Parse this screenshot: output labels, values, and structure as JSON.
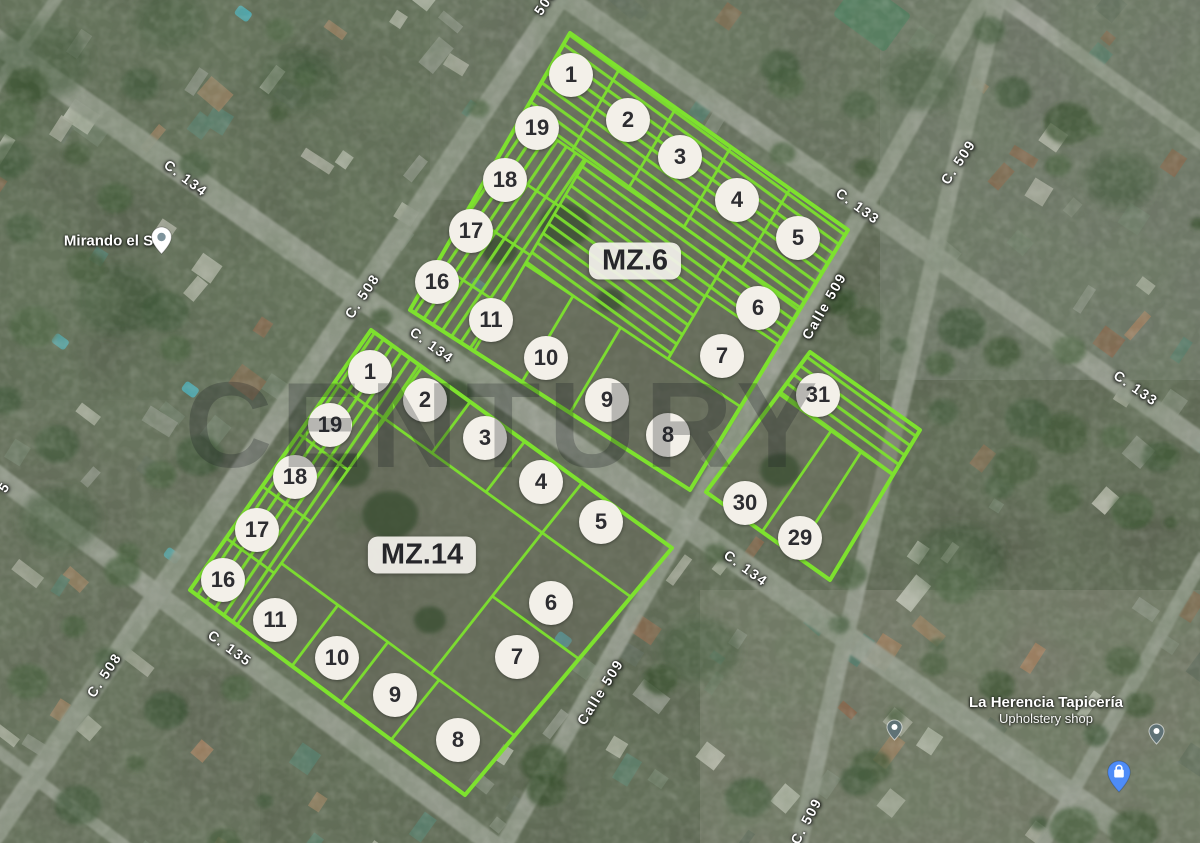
{
  "map_overlay": {
    "watermark_text": "CENTURY",
    "blocks": [
      {
        "name": "mz6",
        "label": "MZ.6",
        "label_x": 635,
        "label_y": 261,
        "lots": [
          {
            "n": "1",
            "x": 571,
            "y": 75
          },
          {
            "n": "2",
            "x": 628,
            "y": 120
          },
          {
            "n": "3",
            "x": 680,
            "y": 157
          },
          {
            "n": "4",
            "x": 737,
            "y": 200
          },
          {
            "n": "5",
            "x": 798,
            "y": 238
          },
          {
            "n": "19",
            "x": 537,
            "y": 128
          },
          {
            "n": "18",
            "x": 505,
            "y": 180
          },
          {
            "n": "17",
            "x": 471,
            "y": 231
          },
          {
            "n": "16",
            "x": 437,
            "y": 282
          },
          {
            "n": "11",
            "x": 491,
            "y": 320
          },
          {
            "n": "10",
            "x": 546,
            "y": 358
          },
          {
            "n": "9",
            "x": 607,
            "y": 400
          },
          {
            "n": "8",
            "x": 668,
            "y": 435
          },
          {
            "n": "6",
            "x": 758,
            "y": 308
          },
          {
            "n": "7",
            "x": 722,
            "y": 356
          }
        ]
      },
      {
        "name": "mz14",
        "label": "MZ.14",
        "label_x": 422,
        "label_y": 555,
        "lots": [
          {
            "n": "1",
            "x": 370,
            "y": 372
          },
          {
            "n": "2",
            "x": 425,
            "y": 400
          },
          {
            "n": "3",
            "x": 485,
            "y": 438
          },
          {
            "n": "4",
            "x": 541,
            "y": 482
          },
          {
            "n": "5",
            "x": 601,
            "y": 522
          },
          {
            "n": "19",
            "x": 330,
            "y": 425
          },
          {
            "n": "18",
            "x": 295,
            "y": 477
          },
          {
            "n": "17",
            "x": 257,
            "y": 530
          },
          {
            "n": "16",
            "x": 223,
            "y": 580
          },
          {
            "n": "11",
            "x": 275,
            "y": 620
          },
          {
            "n": "10",
            "x": 337,
            "y": 658
          },
          {
            "n": "9",
            "x": 395,
            "y": 695
          },
          {
            "n": "8",
            "x": 458,
            "y": 740
          },
          {
            "n": "6",
            "x": 551,
            "y": 603
          },
          {
            "n": "7",
            "x": 517,
            "y": 657
          }
        ]
      },
      {
        "name": "east",
        "label": "",
        "label_x": 0,
        "label_y": 0,
        "lots": [
          {
            "n": "31",
            "x": 818,
            "y": 395
          },
          {
            "n": "30",
            "x": 745,
            "y": 503
          },
          {
            "n": "29",
            "x": 800,
            "y": 538
          }
        ]
      }
    ],
    "street_labels": [
      {
        "text": "C. 134",
        "x": 186,
        "y": 178,
        "rot": 37
      },
      {
        "text": "C. 508",
        "x": 362,
        "y": 296,
        "rot": -56
      },
      {
        "text": "C. 133",
        "x": 858,
        "y": 206,
        "rot": 36
      },
      {
        "text": "C. 509",
        "x": 958,
        "y": 162,
        "rot": -56
      },
      {
        "text": "Calle 509",
        "x": 824,
        "y": 306,
        "rot": -60
      },
      {
        "text": "C. 134",
        "x": 432,
        "y": 345,
        "rot": 36
      },
      {
        "text": "C. 133",
        "x": 1136,
        "y": 388,
        "rot": 35
      },
      {
        "text": "C. 134",
        "x": 746,
        "y": 568,
        "rot": 36
      },
      {
        "text": "C. 135",
        "x": 230,
        "y": 648,
        "rot": 36
      },
      {
        "text": "C. 508",
        "x": 104,
        "y": 675,
        "rot": -56
      },
      {
        "text": "Calle 509",
        "x": 600,
        "y": 692,
        "rot": -58
      },
      {
        "text": "C. 509",
        "x": 806,
        "y": 821,
        "rot": -62
      },
      {
        "text": "508",
        "x": 545,
        "y": 2,
        "rot": -56
      },
      {
        "text": "5",
        "x": 4,
        "y": 487,
        "rot": -56
      }
    ],
    "pois": [
      {
        "name": "Mirando el Sur",
        "sub": "",
        "x": 116,
        "y": 241,
        "pin": "white",
        "pin_x": 150,
        "pin_y": 226
      },
      {
        "name": "La Herencia Tapicería",
        "sub": "Upholstery shop",
        "x": 1046,
        "y": 710,
        "pin": "blue",
        "pin_x": 1106,
        "pin_y": 760
      }
    ],
    "small_markers": [
      {
        "x": 886,
        "y": 719
      },
      {
        "x": 1148,
        "y": 723
      }
    ],
    "colors": {
      "overlay_green": "#7de22e",
      "circle_fill": "#f3f0e9",
      "number_color": "#2d2d31",
      "label_white": "#ffffff",
      "blue_pin": "#4e8cf7"
    }
  }
}
